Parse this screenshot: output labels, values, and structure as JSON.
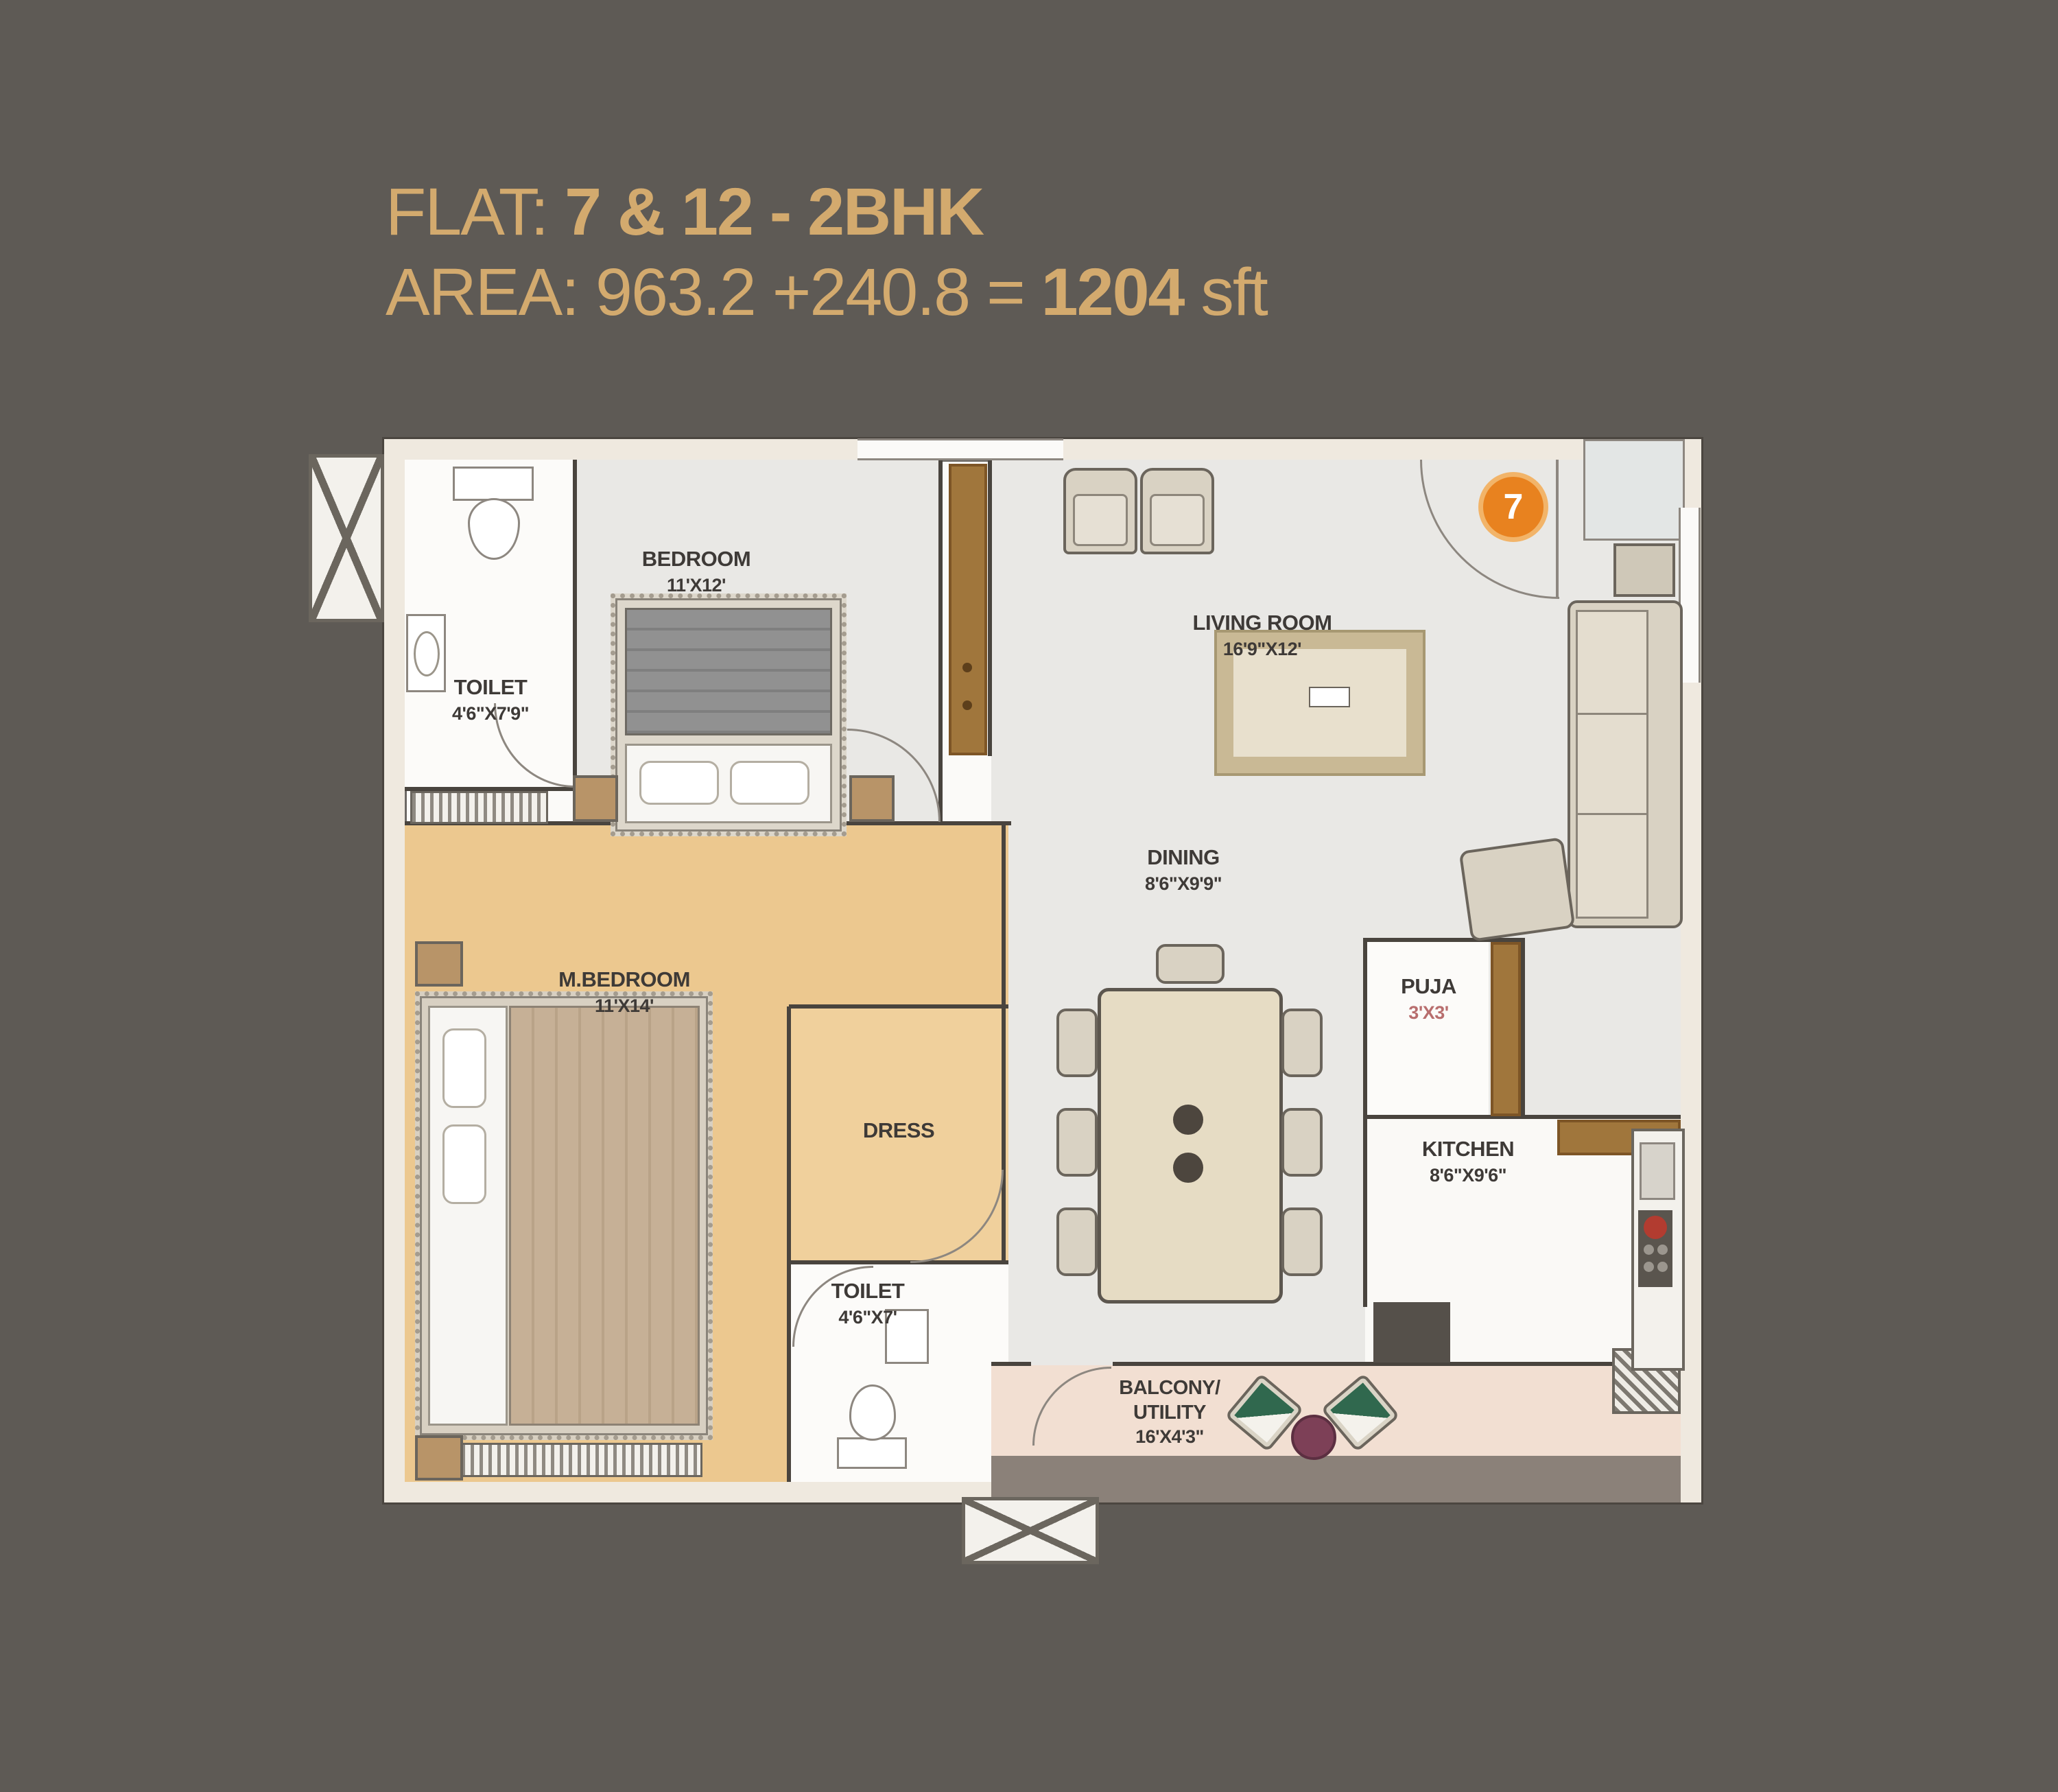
{
  "title": {
    "flat_prefix": "FLAT: ",
    "flat_value": "7 & 12 - 2BHK",
    "area_prefix": "AREA: 963.2 +240.8 = ",
    "area_total": "1204",
    "area_unit": " sft"
  },
  "badge": {
    "number": "7"
  },
  "rooms": [
    {
      "name": "TOILET",
      "dims": "4'6\"X7'9\""
    },
    {
      "name": "BEDROOM",
      "dims": "11'X12'"
    },
    {
      "name": "LIVING ROOM",
      "dims": "16'9\"X12'"
    },
    {
      "name": "M.BEDROOM",
      "dims": "11'X14'"
    },
    {
      "name": "DRESS",
      "dims": ""
    },
    {
      "name": "DINING",
      "dims": "8'6\"X9'9\""
    },
    {
      "name": "PUJA",
      "dims": "3'X3'"
    },
    {
      "name": "KITCHEN",
      "dims": "8'6\"X9'6\""
    },
    {
      "name": "TOILET",
      "dims": "4'6\"X7'"
    },
    {
      "name": "BALCONY/",
      "name2": "UTILITY",
      "dims": "16'X4'3\""
    }
  ],
  "colors": {
    "background": "#5e5a55",
    "title_gold": "#d3aa6e",
    "badge_orange": "#e8821f",
    "wall_cream": "#efe9df",
    "floor_gray": "#e9e8e5",
    "floor_wood": "#ecc88f",
    "floor_balcony": "#f2dfd2"
  }
}
